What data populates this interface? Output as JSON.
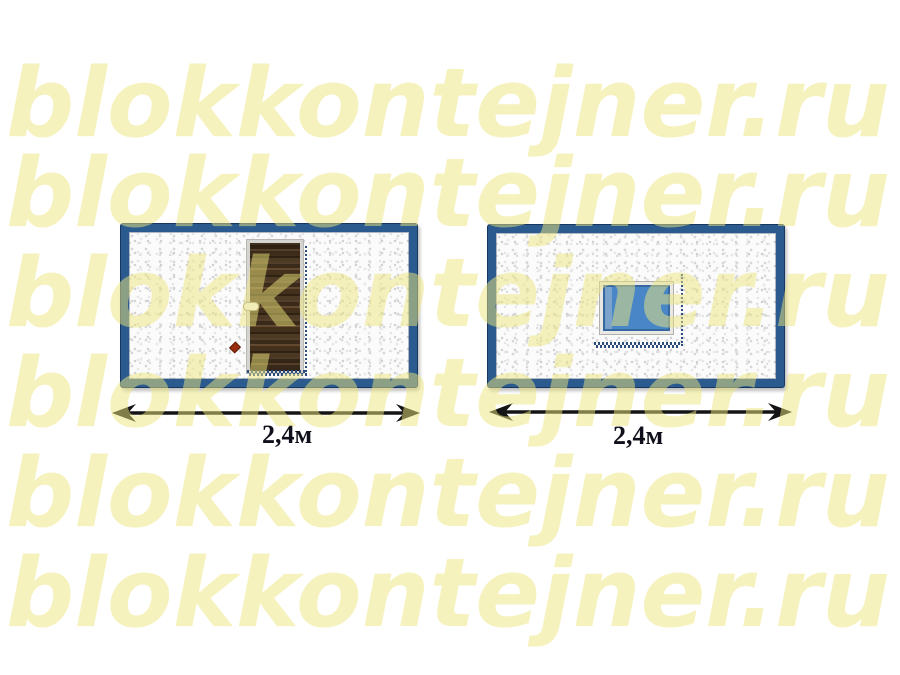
{
  "watermark": {
    "text": "blokkontejner.ru",
    "color": "#F6F2C0",
    "row_count": 6
  },
  "left_diagram": {
    "feature": "door",
    "dimension_label": "2,4м"
  },
  "right_diagram": {
    "feature": "window",
    "dimension_label": "2,4м"
  },
  "colors": {
    "container_frame_blue": "#2A5A8E",
    "container_frame_outline": "#17375E",
    "window_glass_blue": "#4886C8",
    "door_wood_brown": "#42301D",
    "marquee_dot_blue": "#2B4D7E",
    "diamond_marker_red": "#9A2D0E",
    "arrow_black": "#141414"
  }
}
